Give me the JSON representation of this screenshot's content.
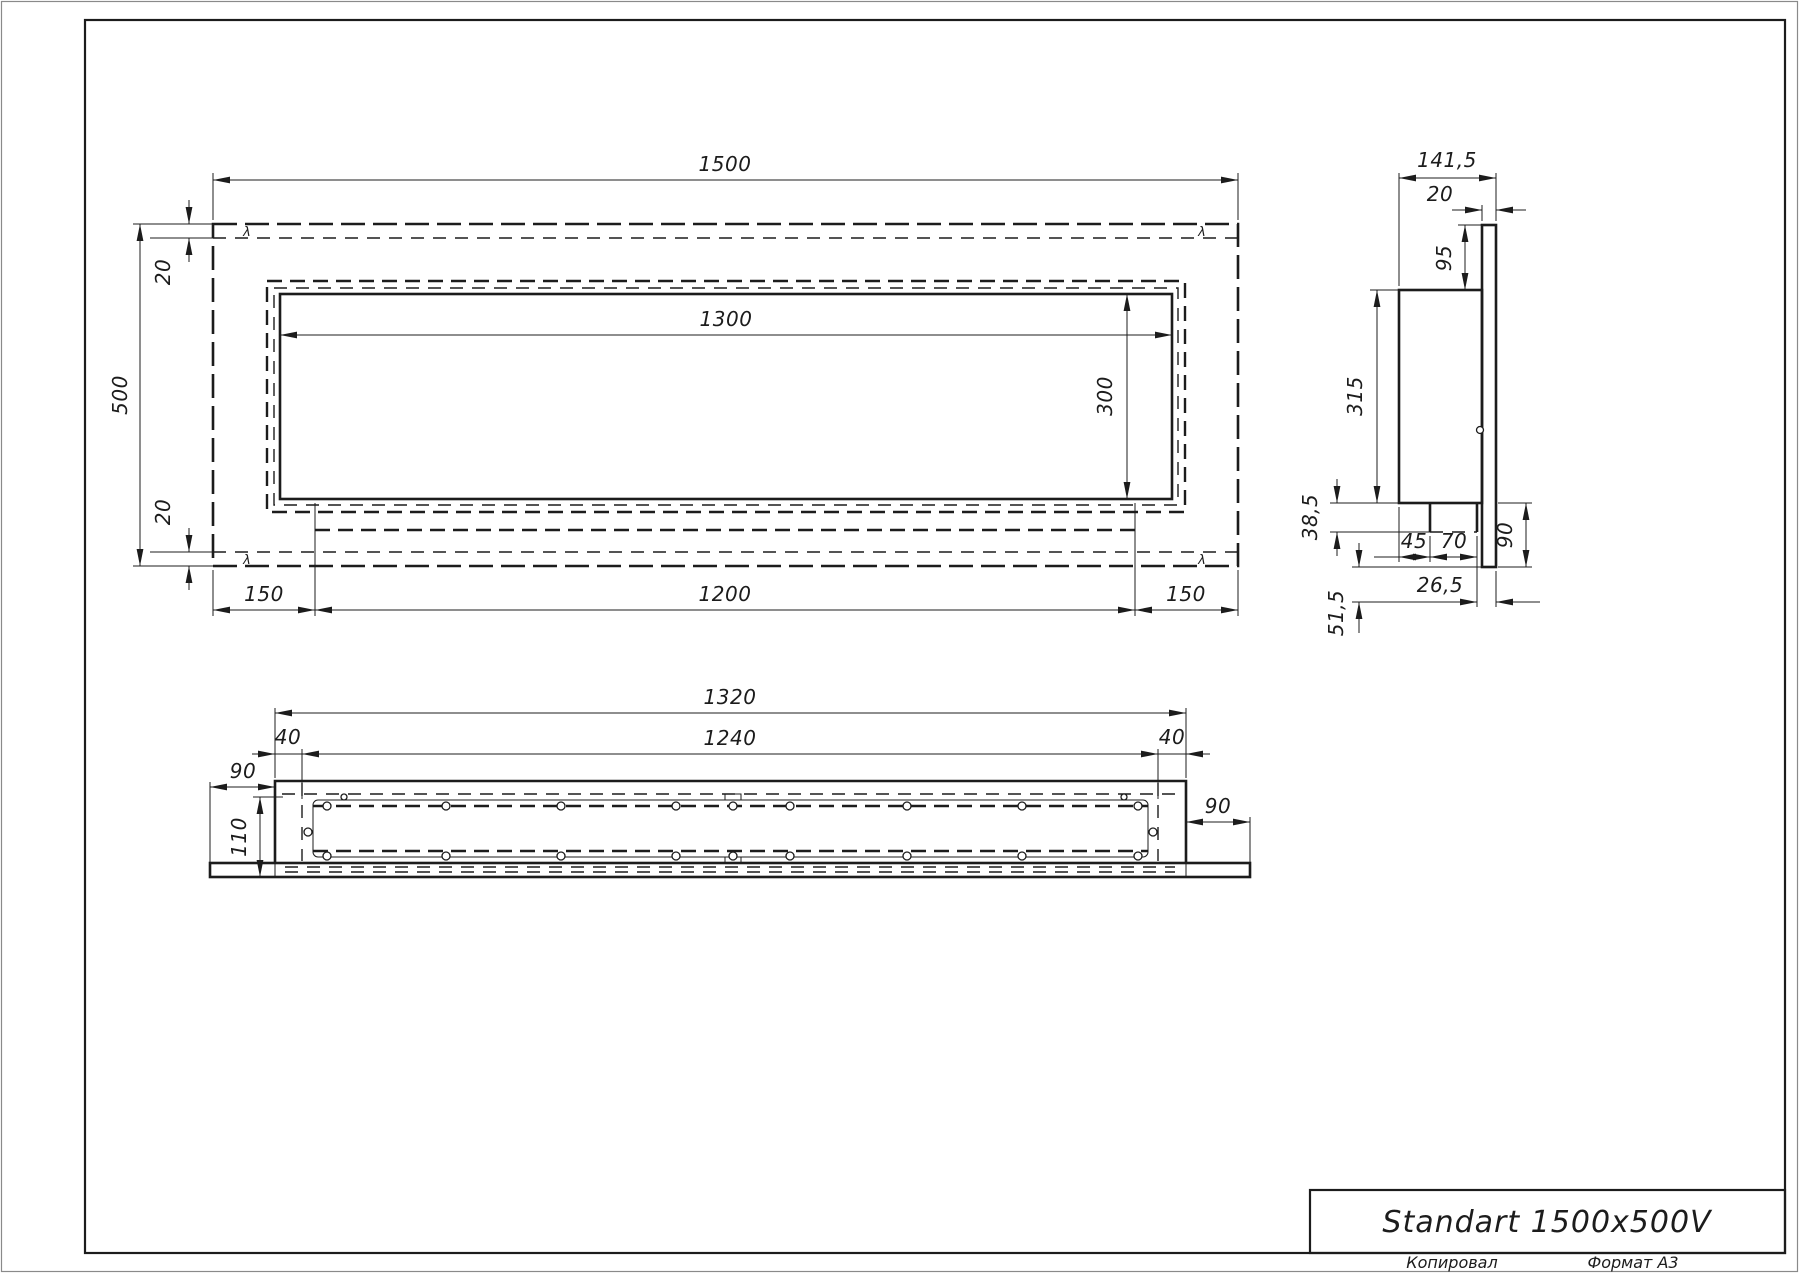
{
  "title_block": {
    "title": "Standart 1500x500V",
    "copied": "Копировал",
    "format": "Формат А3"
  },
  "front": {
    "dim_width": "1500",
    "dim_height": "500",
    "dim_inset_top": "20",
    "dim_inset_bottom": "20",
    "dim_opening_width": "1300",
    "dim_opening_height": "300",
    "dim_left_margin": "150",
    "dim_burner_width": "1200",
    "dim_right_margin": "150"
  },
  "side": {
    "dim_depth": "141,5",
    "dim_flange_thickness": "20",
    "dim_top_inset": "95",
    "dim_body_height": "315",
    "dim_tray_height": "38,5",
    "dim_tray_offset": "45",
    "dim_tray_depth": "70",
    "dim_flange_overhang": "90",
    "dim_lip_offset": "26,5",
    "dim_bottom_offset": "51,5"
  },
  "bottom": {
    "dim_body_width": "1320",
    "dim_inner_width": "1240",
    "dim_end_left": "40",
    "dim_end_right": "40",
    "dim_flange_left": "90",
    "dim_flange_right": "90",
    "dim_depth": "110"
  },
  "marks": {
    "weld": "λ"
  },
  "colors": {
    "ink": "#1c1c1c",
    "paper": "#ffffff"
  }
}
